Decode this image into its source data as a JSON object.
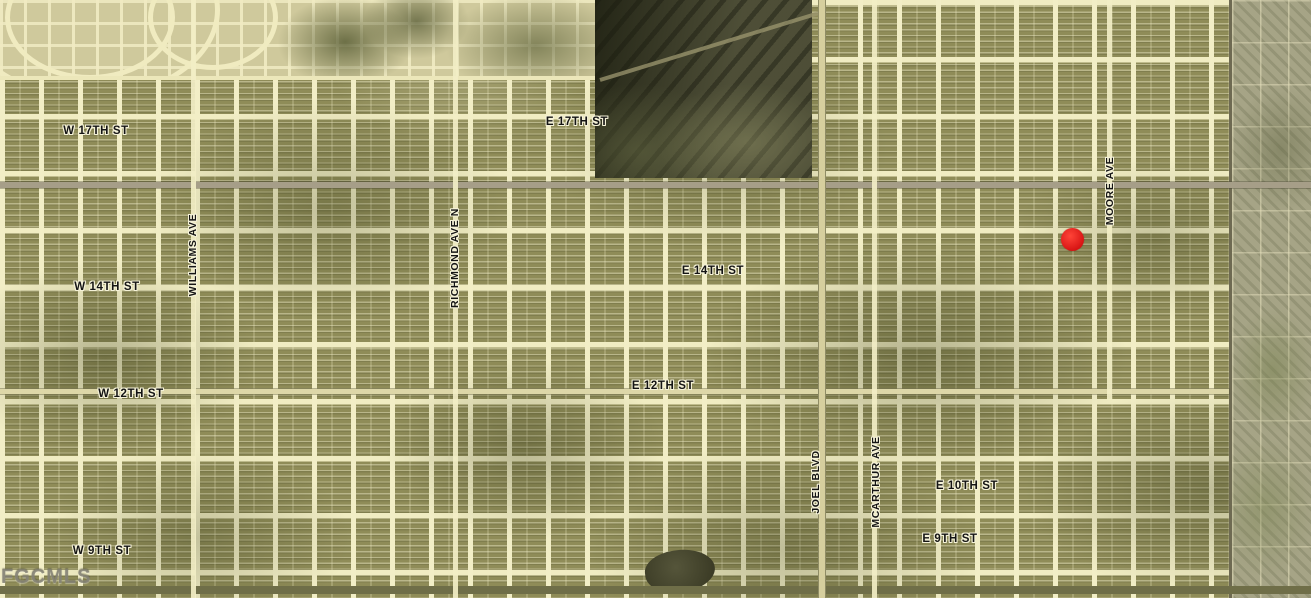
{
  "map": {
    "description": "Aerial satellite view of a platted subdivision street grid with labeled streets and a red location marker",
    "street_labels": [
      {
        "text": "W 17TH ST",
        "orientation": "horizontal"
      },
      {
        "text": "E 17TH ST",
        "orientation": "horizontal"
      },
      {
        "text": "W 14TH ST",
        "orientation": "horizontal"
      },
      {
        "text": "E 14TH ST",
        "orientation": "horizontal"
      },
      {
        "text": "W 12TH ST",
        "orientation": "horizontal"
      },
      {
        "text": "E 12TH ST",
        "orientation": "horizontal"
      },
      {
        "text": "W 9TH ST",
        "orientation": "horizontal"
      },
      {
        "text": "E 10TH ST",
        "orientation": "horizontal"
      },
      {
        "text": "E 9TH ST",
        "orientation": "horizontal"
      },
      {
        "text": "WILLIAMS AVE",
        "orientation": "vertical"
      },
      {
        "text": "RICHMOND AVE N",
        "orientation": "vertical"
      },
      {
        "text": "MOORE AVE",
        "orientation": "vertical"
      },
      {
        "text": "JOEL BLVD",
        "orientation": "vertical"
      },
      {
        "text": "MCARTHUR AVE",
        "orientation": "vertical"
      }
    ],
    "marker": {
      "name": "location-dot",
      "color": "#d51212"
    },
    "watermark": {
      "text": "FGCMLS"
    },
    "colors": {
      "street_cream": "#f2eec6",
      "lot_olive": "#8f8c58",
      "major_road_gray": "#a69e88",
      "rural_strip": "#a6a486",
      "excavation_dark": "#50503a",
      "marker_red": "#d51212"
    }
  }
}
